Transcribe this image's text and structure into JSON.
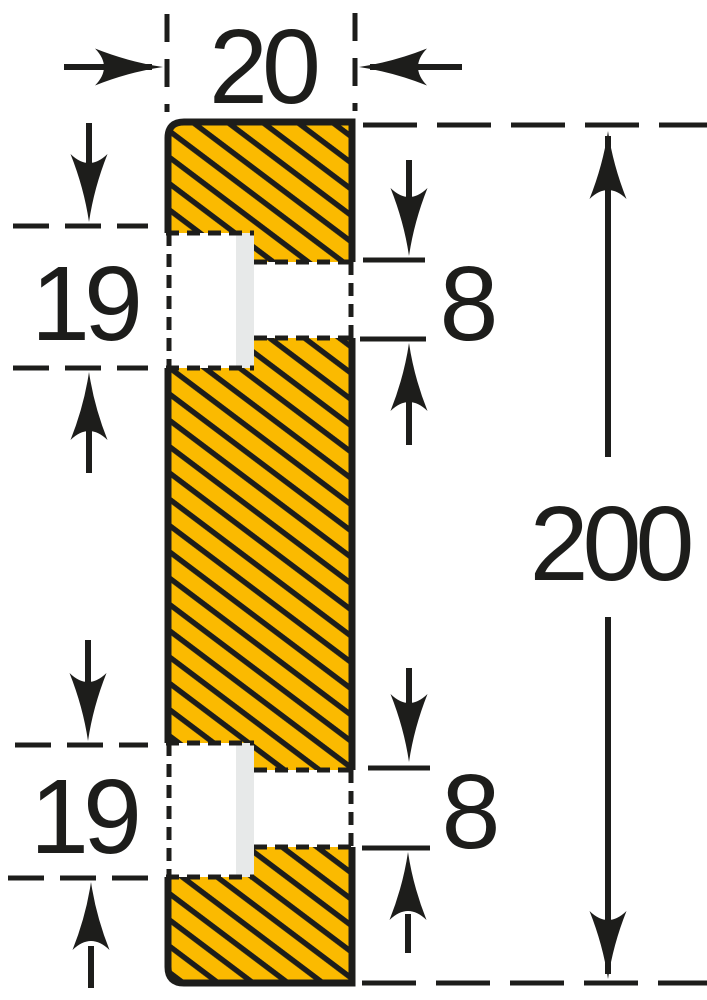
{
  "diagram": {
    "name": "profile-cross-section-dimension-drawing",
    "description": "Cross-section of a hatched surface-protection profile with two stepped fixing holes and dimension arrows"
  },
  "colors": {
    "background": "#ffffff",
    "profile_fill": "#fbba00",
    "line": "#1d1d1b",
    "cutout": "#ffffff",
    "recess_strip": "#e7e9e9"
  },
  "dimensions": {
    "width": {
      "value": "20"
    },
    "height": {
      "value": "200"
    },
    "notch_top": {
      "value": "19"
    },
    "notch_bottom": {
      "value": "19"
    },
    "hole_top": {
      "value": "8"
    },
    "hole_bottom": {
      "value": "8"
    }
  }
}
